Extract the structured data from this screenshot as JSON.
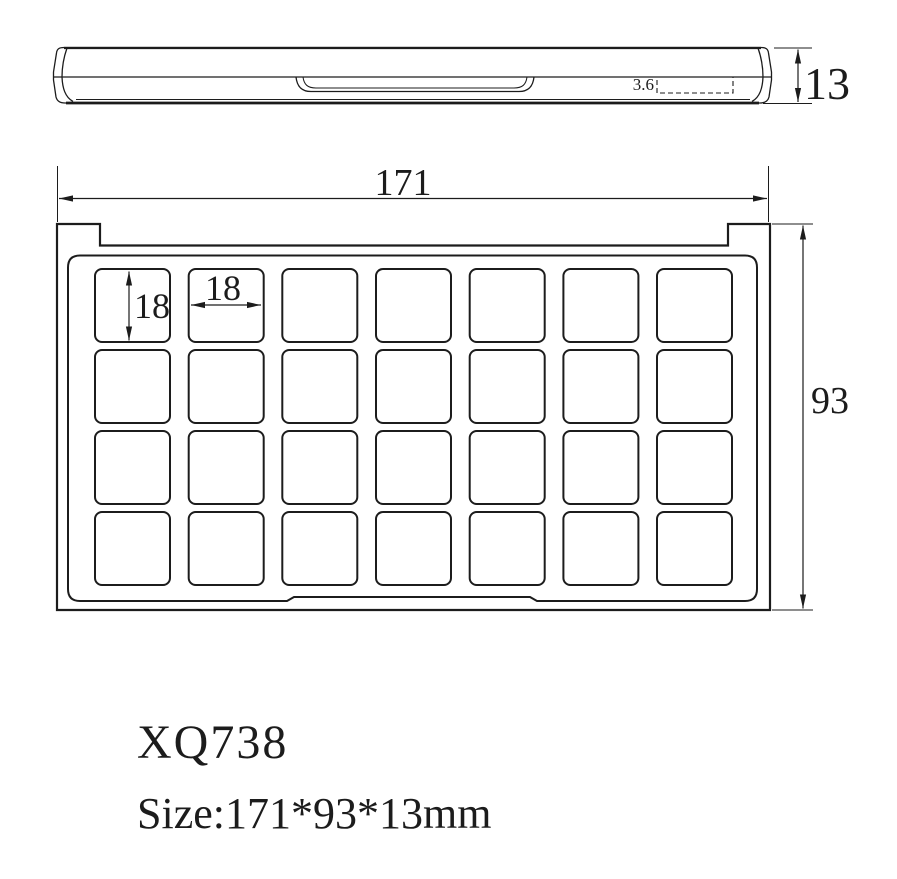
{
  "drawing": {
    "side_view": {
      "thickness": "13",
      "pocket_depth": "3.6"
    },
    "top_view": {
      "overall_width": "171",
      "overall_height": "93",
      "cell_width": "18",
      "cell_height": "18",
      "grid": {
        "rows": 4,
        "cols": 7
      }
    },
    "title_block": {
      "model": "XQ738",
      "size_label": "Size:171*93*13mm"
    },
    "colors": {
      "line": "#1c1c1c",
      "background": "#ffffff"
    }
  }
}
